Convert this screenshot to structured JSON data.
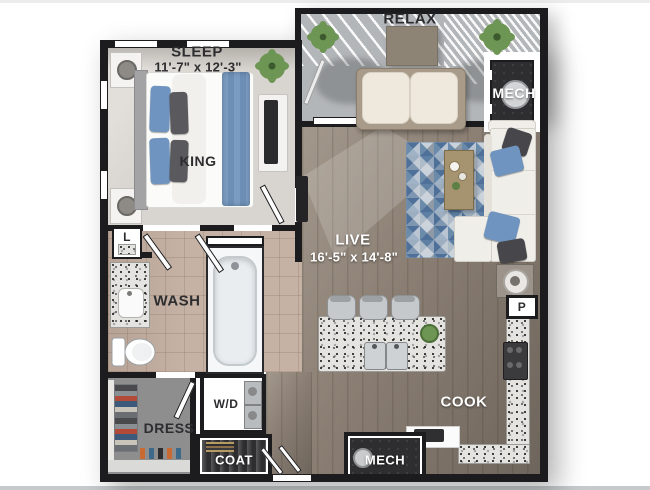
{
  "title": "One-bedroom apartment 3D floor plan",
  "colors": {
    "wall": "#1c1c1e",
    "carpet": "#d8d4cf",
    "tile": "#c5b2a4",
    "wood": "#8a7e73",
    "wood_dark": "#6e655c",
    "wood_light": "#a3988c",
    "balcony": "#b3b6b9",
    "dark_room": "#2e2e30",
    "dress_floor": "#8e8e8f",
    "granite_base": "#e4e3e0",
    "rug_blue": "#4f7199",
    "rug_mid": "#6b8bab",
    "rug_light": "#c2cbd4",
    "rug_gray": "#8f9aa6",
    "pillow_blue": "#6f94bf",
    "pillow_dark": "#47474b",
    "sofa": "#f0eee9",
    "accent_tan": "#a89b8a",
    "plant_green": "#6d9553",
    "label_dark": "#2d2d2f"
  },
  "rooms": [
    {
      "id": "sleep",
      "label": "SLEEP",
      "dimensions": "11'-7\" x 12'-3\""
    },
    {
      "id": "relax",
      "label": "RELAX"
    },
    {
      "id": "mech_upper",
      "label": "MECH"
    },
    {
      "id": "live",
      "label": "LIVE",
      "dimensions": "16'-5\" x 14'-8\""
    },
    {
      "id": "wash",
      "label": "WASH"
    },
    {
      "id": "dress",
      "label": "DRESS"
    },
    {
      "id": "coat",
      "label": "COAT"
    },
    {
      "id": "cook",
      "label": "COOK"
    },
    {
      "id": "mech_lower",
      "label": "MECH"
    }
  ],
  "fixtures": [
    {
      "id": "king_bed",
      "label": "KING"
    },
    {
      "id": "linen_closet",
      "label": "L"
    },
    {
      "id": "pantry",
      "label": "P"
    },
    {
      "id": "washer_dryer",
      "label": "W/D"
    }
  ]
}
